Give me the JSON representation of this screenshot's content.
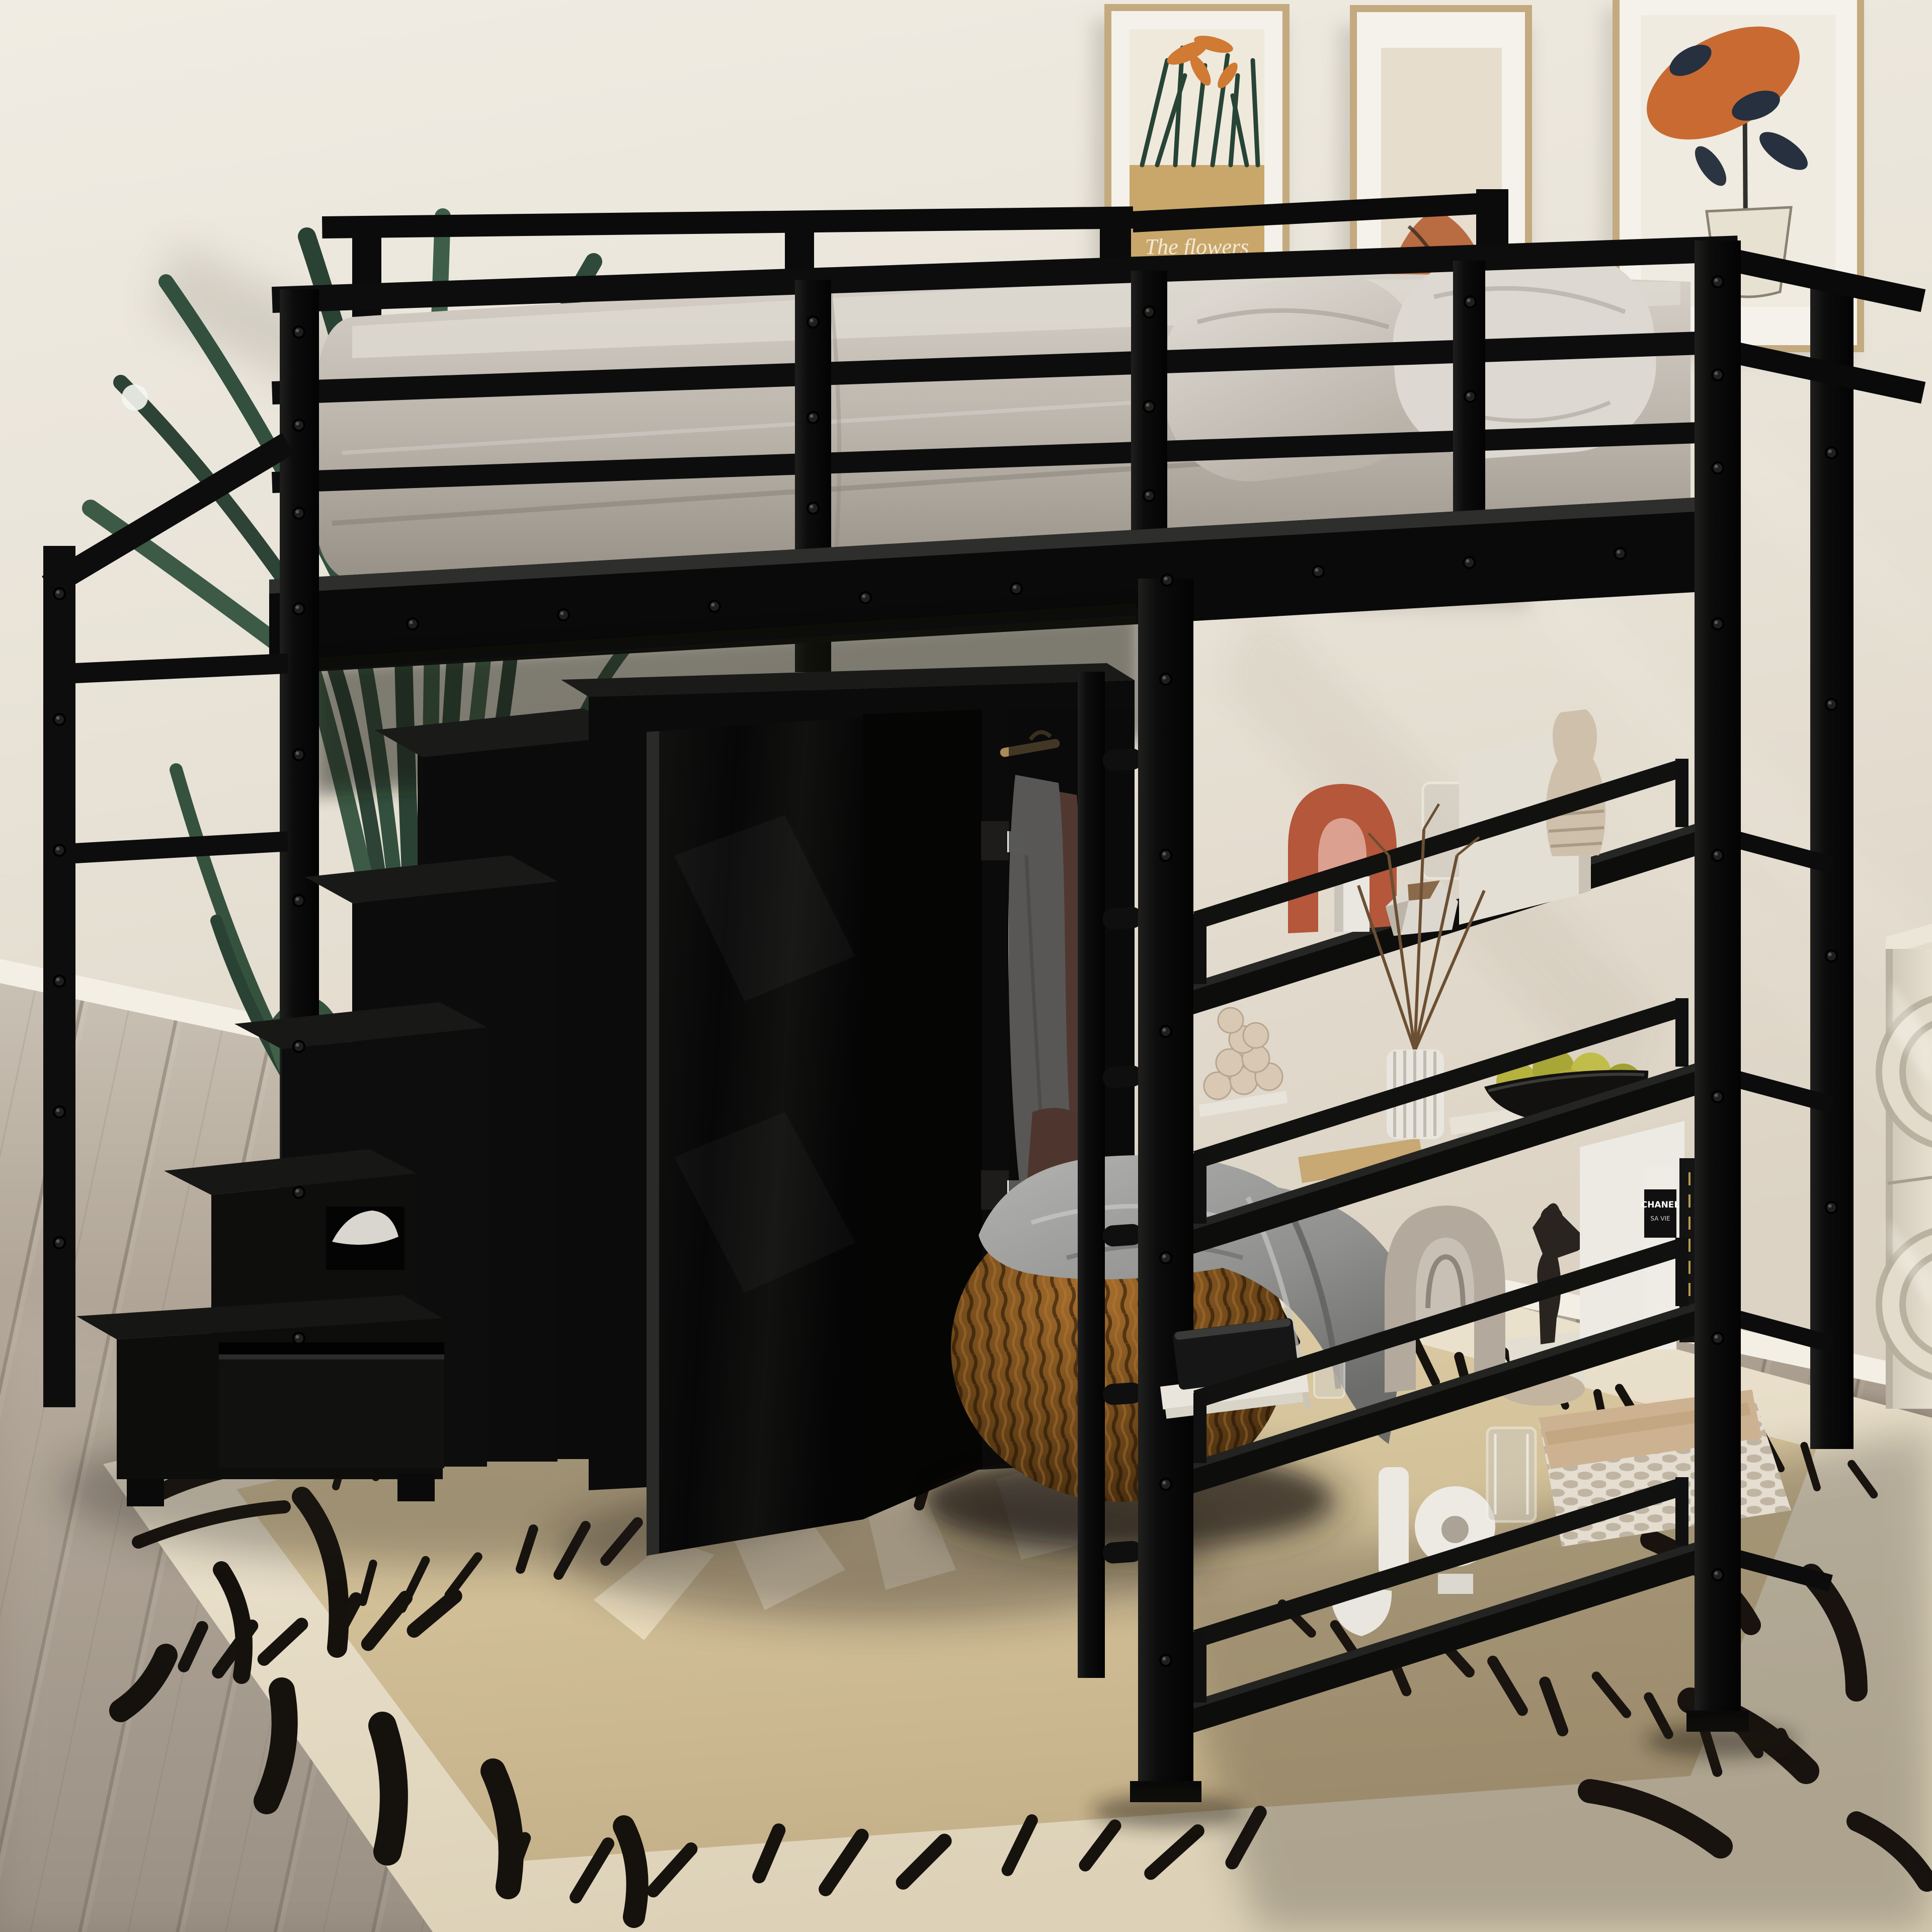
{
  "meta": {
    "type": "product lifestyle photo",
    "description": "Black metal twin loft bed with storage staircase on the left, a wardrobe with an open door underneath, a climbing ladder and a four-tier black shelf unit on the right, styled in a beige bedroom with a palm plant, three framed art prints, a knitted pouf with a gray throw, and a cream tribal-pattern rug on a wood floor."
  },
  "texts": {
    "art_caption": "The flowers",
    "magazine_title": "CHANEL",
    "magazine_subtitle": "SA VIE"
  },
  "palette": {
    "wall": "#e9e4da",
    "floor_wood": "#a89f93",
    "metal_frame_black": "#0d0d0d",
    "mattress_gray": "#bdb7ae",
    "pillow_gray": "#d8d3cc",
    "rug_cream": "#ece4d0",
    "rug_tan_field": "#d5c5a0",
    "rug_pattern_black": "#15110d",
    "pouf_brown": "#6e4719",
    "blanket_gray": "#9b9b9a",
    "plant_green": "#3a553f",
    "frame_gold": "#c3aa7f",
    "art_terracotta": "#b96b42",
    "dresser_cream": "#d9d2c4",
    "terracotta_arch": "#b4573b",
    "fruit_green": "#b2ae3e",
    "clothes_white": "#e7e4df",
    "clothes_peach": "#d28e79"
  },
  "scene": {
    "wall_art": [
      {
        "name": "botanical print with tan field and orange flowers",
        "caption": "The flowers"
      },
      {
        "name": "tall abstract terracotta figure print",
        "caption": ""
      },
      {
        "name": "orange leaf with navy leaves in sketched vase print",
        "caption": ""
      }
    ],
    "furniture": [
      "loft bed with full-length guardrails and riveted black metal frame",
      "storage staircase with stepped cabinets and bottom drawer",
      "wardrobe with open hinged door and hanging clothes",
      "vertical climbing ladder",
      "four-tier open shelf unit between bed legs",
      "cream dresser with round recessed pulls (right edge)"
    ],
    "shelf_items": {
      "tier1": [
        "terracotta arch sculpture",
        "white square vase",
        "faceted stone object",
        "leaning white canvas",
        "glass vase",
        "beige ceramic vase"
      ],
      "tier2": [
        "stacked-ball sculpture on white base",
        "tan book",
        "white fluted vase with dry branches",
        "flat book stack",
        "black bowl with green apples"
      ],
      "tier3": [
        "black glossy box on white books",
        "glass jar",
        "taupe layered arch decor",
        "bronze figurine on stone block",
        "leaning white canvas",
        "CHANEL magazines"
      ],
      "tier4": [
        "white cylinder vase",
        "white donut vase",
        "glass cup",
        "white bowl",
        "beige oval vase",
        "two lotion bottles",
        "woven basket with fabric liner"
      ]
    },
    "props": [
      "areca palm plant",
      "knitted brown pouf",
      "gray throw blanket",
      "tribal dash-pattern rug"
    ]
  }
}
